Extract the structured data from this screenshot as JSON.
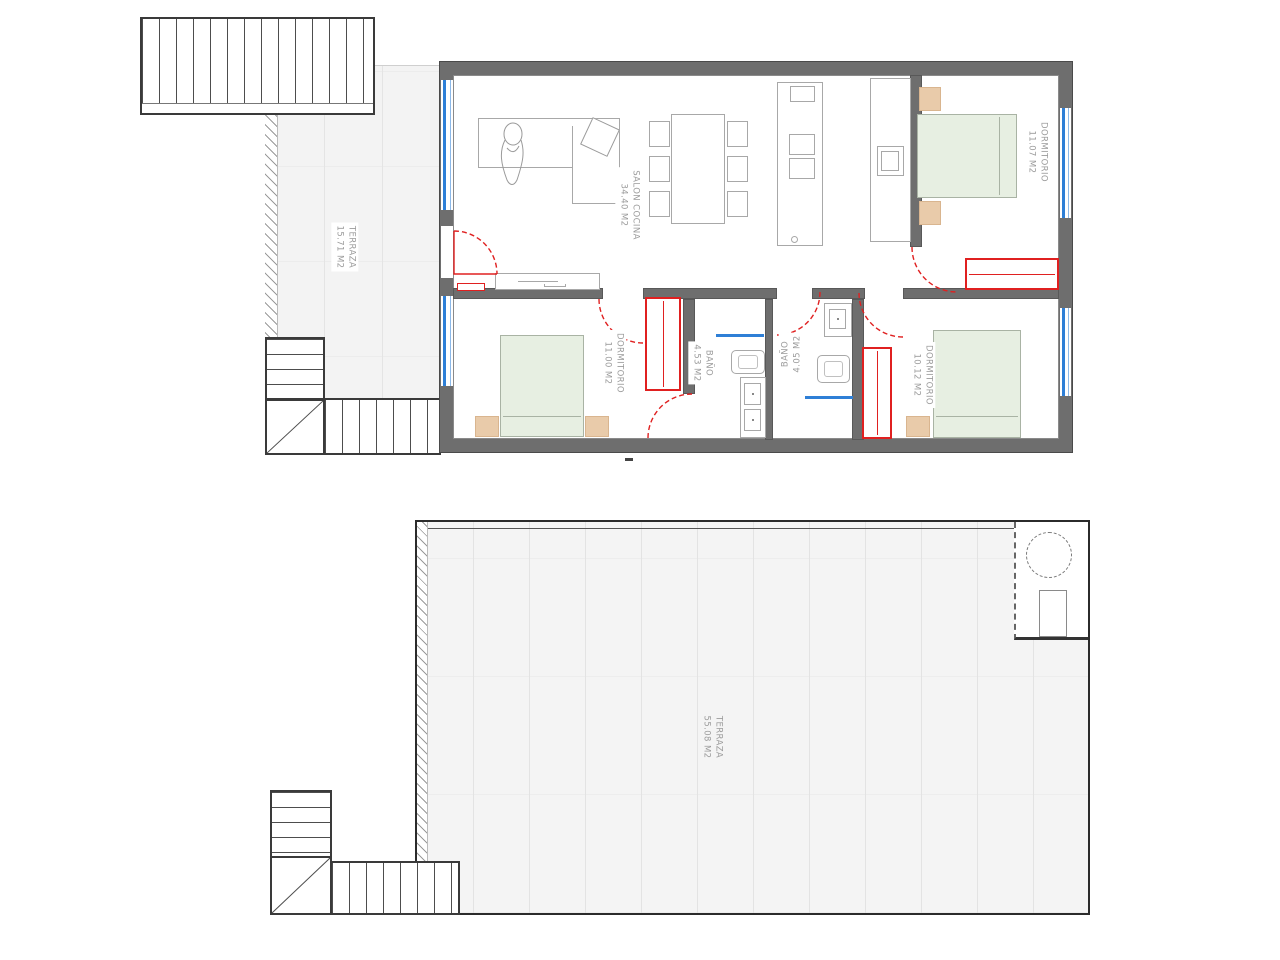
{
  "colors": {
    "wall_gray": "#6e6e6e",
    "door_red": "#e02020",
    "window_blue": "#2e7fd6",
    "bed_green": "#e7efe2",
    "nightstand_tan": "#e9cbaa",
    "tile_gray": "#f3f3f3",
    "furniture_line_gray": "#a8a8a8",
    "label_gray": "#9b9b9b"
  },
  "upper_plan": {
    "labels": {
      "terrace": {
        "name": "TERRAZA",
        "area": "15.71 M2"
      },
      "living_kitchen": {
        "name": "SALON COCINA",
        "area": "34.40 M2"
      },
      "bedroom_top_right": {
        "name": "DORMITORIO",
        "area": "11.07 M2"
      },
      "bedroom_bottom_left": {
        "name": "DORMITORIO",
        "area": "11.00 M2"
      },
      "bath_left": {
        "name": "BAÑO",
        "area": "4.53 M2"
      },
      "bath_right": {
        "name": "BAÑO",
        "area": "4.05 M2"
      },
      "bedroom_bottom_right": {
        "name": "DORMITORIO",
        "area": "10.12 M2"
      }
    }
  },
  "roof_plan": {
    "labels": {
      "terrace": {
        "name": "TERRAZA",
        "area": "55.08 M2"
      }
    }
  }
}
